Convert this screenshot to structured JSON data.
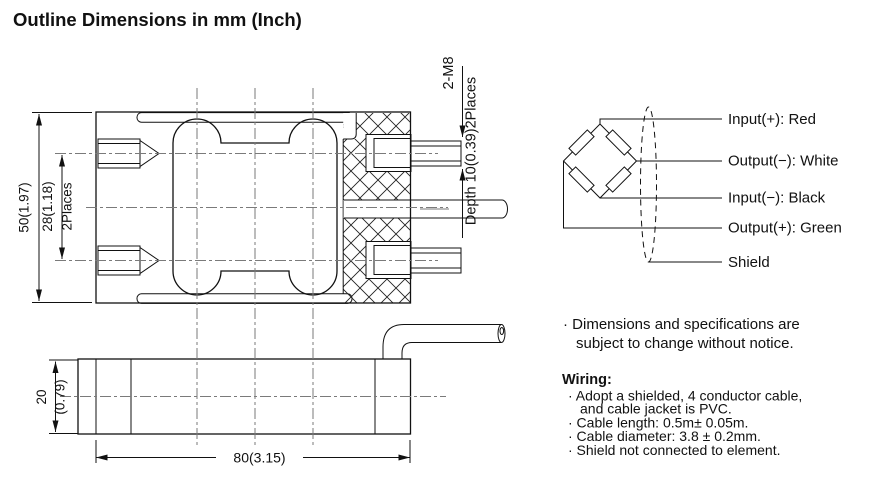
{
  "title": "Outline Dimensions in mm (Inch)",
  "colors": {
    "line": "#111111",
    "background": "#ffffff",
    "centerline": "#7a7a7a"
  },
  "top_view": {
    "dim_height": "50(1.97)",
    "dim_bolt_spacing": "28(1.18)",
    "dim_bolt_spacing_places": "2Places",
    "thread_label": "2-M8",
    "thread_depth_label": "Depth 10(0.39)2Places"
  },
  "side_view": {
    "dim_thickness_mm": "20",
    "dim_thickness_inch": "(0.79)",
    "dim_length": "80(3.15)"
  },
  "wiring_diagram": {
    "labels": [
      "Input(+): Red",
      "Output(−): White",
      "Input(−): Black",
      "Output(+): Green",
      "Shield"
    ]
  },
  "notes": {
    "disclaimer_line1": "· Dimensions and specifications are",
    "disclaimer_line2": "subject to change without notice.",
    "wiring_title": "Wiring:",
    "wiring_items": [
      "· Adopt a shielded,  4 conductor cable,",
      "and  cable jacket is PVC.",
      "· Cable length: 0.5m± 0.05m.",
      "· Cable diameter: 3.8 ± 0.2mm.",
      "· Shield not connected  to element."
    ]
  }
}
